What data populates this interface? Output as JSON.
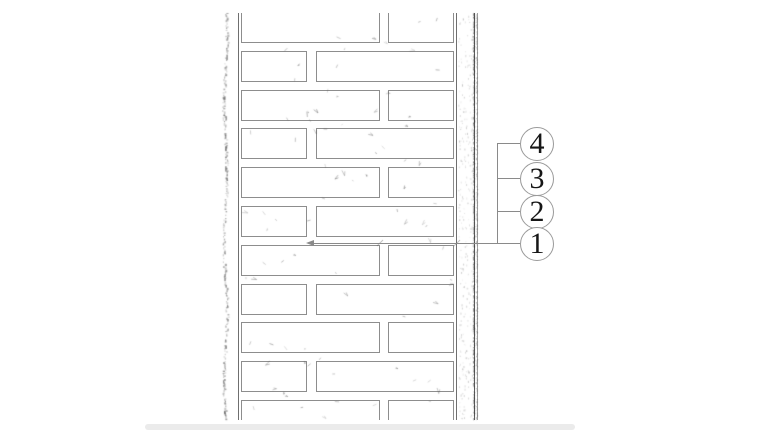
{
  "colors": {
    "background": "#ffffff",
    "wall_line": "#6f6f6f",
    "brick_outline": "#8d8d8d",
    "leader_line": "#8a8a8a",
    "callout_border": "#9a9a9a",
    "callout_number": "#161616",
    "stipple": "#9b9b9b",
    "artifact_band": "#ebebeb"
  },
  "wall": {
    "bond": "running",
    "row_count": 11,
    "first_row_top": -1,
    "row_pitch": 38.8,
    "brick_height": 31,
    "row_sequence": [
      "B",
      "A",
      "B",
      "A",
      "B",
      "A",
      "B",
      "A",
      "B",
      "A",
      "B"
    ],
    "row_layouts": {
      "A": [
        {
          "x": 1,
          "w": 66
        },
        {
          "x": 76,
          "w": 138
        }
      ],
      "B": [
        {
          "x": 1,
          "w": 139
        },
        {
          "x": 148,
          "w": 66
        }
      ]
    }
  },
  "callouts": [
    {
      "label": "4",
      "cy": 143
    },
    {
      "label": "3",
      "cy": 178
    },
    {
      "label": "2",
      "cy": 211
    },
    {
      "label": "1",
      "cy": 243
    }
  ],
  "leader": {
    "connector_x": 497,
    "circle_left_x": 520,
    "target_x": 313,
    "target_y": 243
  }
}
